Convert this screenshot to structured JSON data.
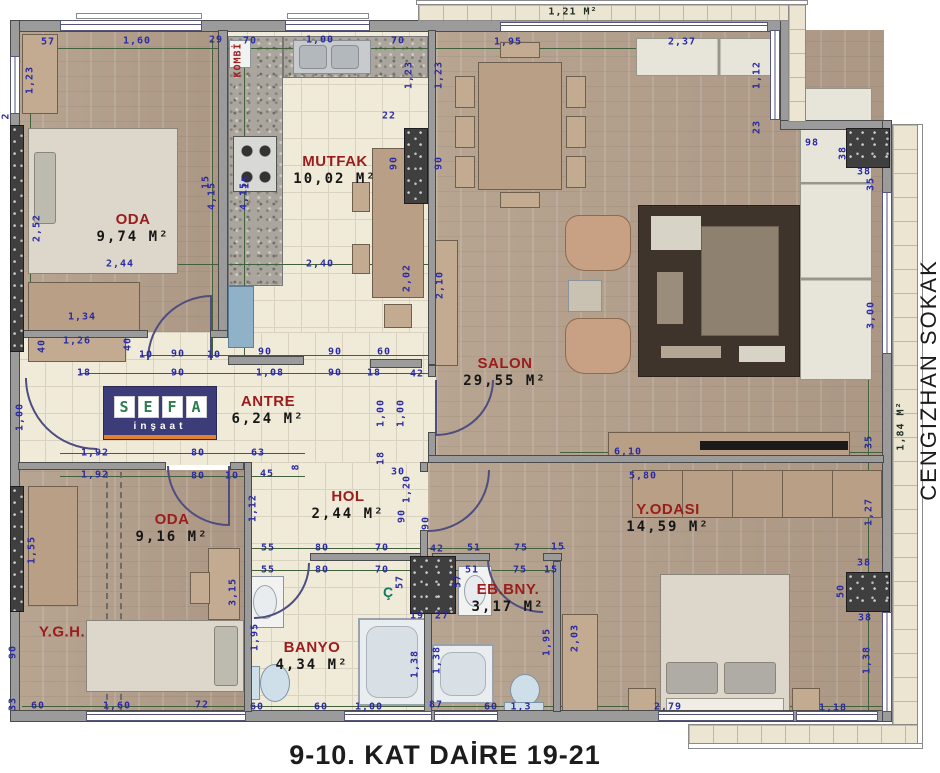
{
  "title": "9-10. KAT DAİRE 19-21",
  "street_label": "CENGIZHAN SOKAK",
  "logo": {
    "brand": "SEFA",
    "sub": "inşaat"
  },
  "shaft_label": "Ç",
  "boiler_label": "KOMBİ",
  "balcony_top_area": "1,21 M²",
  "balcony_right_area": "1,84 M²",
  "colors": {
    "dim_blue": "#2a2aa4",
    "line_green": "#42603a",
    "room_red": "#9a1c1c",
    "logo_navy": "#3c3c78",
    "logo_green": "#2e7d4f",
    "logo_orange": "#e08030"
  },
  "rooms": [
    {
      "label": "ODA",
      "area": "9,74 M²",
      "x": 133,
      "y": 228
    },
    {
      "label": "MUTFAK",
      "area": "10,02 M²",
      "x": 335,
      "y": 170
    },
    {
      "label": "SALON",
      "area": "29,55 M²",
      "x": 505,
      "y": 372
    },
    {
      "label": "ANTRE",
      "area": "6,24 M²",
      "x": 268,
      "y": 410
    },
    {
      "label": "HOL",
      "area": "2,44 M²",
      "x": 348,
      "y": 505
    },
    {
      "label": "ODA",
      "area": "9,16 M²",
      "x": 172,
      "y": 528
    },
    {
      "label": "Y.G.H.",
      "area": "",
      "x": 62,
      "y": 632
    },
    {
      "label": "BANYO",
      "area": "4,34 M²",
      "x": 312,
      "y": 656
    },
    {
      "label": "EB.BNY.",
      "area": "3,17 M²",
      "x": 508,
      "y": 598
    },
    {
      "label": "Y.ODASI",
      "area": "14,59 M²",
      "x": 668,
      "y": 518
    }
  ],
  "dimensions": [
    [
      "57",
      48,
      42,
      0
    ],
    [
      "1,60",
      137,
      41,
      0
    ],
    [
      "29",
      216,
      40,
      0
    ],
    [
      "70",
      250,
      41,
      0
    ],
    [
      "1,00",
      320,
      40,
      0
    ],
    [
      "70",
      398,
      41,
      0
    ],
    [
      "1,95",
      508,
      42,
      0
    ],
    [
      "2,37",
      682,
      42,
      0
    ],
    [
      "1,23",
      30,
      80,
      1
    ],
    [
      "2",
      6,
      116,
      1
    ],
    [
      "2,52",
      37,
      228,
      1
    ],
    [
      "1,00",
      20,
      417,
      1
    ],
    [
      "1,55",
      32,
      550,
      1
    ],
    [
      "90",
      13,
      652,
      1
    ],
    [
      "33",
      13,
      704,
      1
    ],
    [
      "2,44",
      120,
      264,
      0
    ],
    [
      "1,34",
      82,
      317,
      0
    ],
    [
      "1,26",
      77,
      341,
      0
    ],
    [
      "40",
      42,
      346,
      1
    ],
    [
      "40",
      128,
      344,
      1
    ],
    [
      "4,15",
      212,
      196,
      1
    ],
    [
      "4,15",
      244,
      196,
      1
    ],
    [
      "15",
      206,
      182,
      1
    ],
    [
      "15",
      246,
      182,
      1
    ],
    [
      "10",
      146,
      355,
      0
    ],
    [
      "90",
      178,
      354,
      0
    ],
    [
      "10",
      214,
      355,
      0
    ],
    [
      "90",
      265,
      352,
      0
    ],
    [
      "90",
      335,
      352,
      0
    ],
    [
      "60",
      384,
      352,
      0
    ],
    [
      "18",
      84,
      373,
      0
    ],
    [
      "90",
      178,
      373,
      0
    ],
    [
      "1,08",
      270,
      373,
      0
    ],
    [
      "90",
      335,
      373,
      0
    ],
    [
      "18",
      374,
      373,
      0
    ],
    [
      "42",
      417,
      374,
      0
    ],
    [
      "1,23",
      409,
      75,
      1
    ],
    [
      "1,23",
      439,
      75,
      1
    ],
    [
      "22",
      389,
      116,
      0
    ],
    [
      "90",
      394,
      163,
      1
    ],
    [
      "90",
      439,
      163,
      1
    ],
    [
      "2,40",
      320,
      264,
      0
    ],
    [
      "2,02",
      407,
      278,
      1
    ],
    [
      "2,10",
      440,
      285,
      1
    ],
    [
      "1,12",
      757,
      75,
      1
    ],
    [
      "23",
      757,
      127,
      1
    ],
    [
      "98",
      812,
      143,
      0
    ],
    [
      "38",
      843,
      153,
      1
    ],
    [
      "38",
      864,
      172,
      0
    ],
    [
      "35",
      871,
      184,
      1
    ],
    [
      "3,00",
      871,
      315,
      1
    ],
    [
      "35",
      869,
      442,
      1
    ],
    [
      "6,10",
      628,
      452,
      0
    ],
    [
      "5,80",
      643,
      476,
      0
    ],
    [
      "1,92",
      95,
      453,
      0
    ],
    [
      "80",
      198,
      453,
      0
    ],
    [
      "63",
      258,
      453,
      0
    ],
    [
      "1,92",
      95,
      475,
      0
    ],
    [
      "80",
      198,
      476,
      0
    ],
    [
      "10",
      232,
      476,
      0
    ],
    [
      "45",
      267,
      474,
      0
    ],
    [
      "8",
      296,
      467,
      1
    ],
    [
      "1,00",
      381,
      413,
      1
    ],
    [
      "1,00",
      401,
      413,
      1
    ],
    [
      "18",
      381,
      458,
      1
    ],
    [
      "30",
      398,
      472,
      0
    ],
    [
      "1,20",
      407,
      489,
      1
    ],
    [
      "90",
      402,
      516,
      1
    ],
    [
      "90",
      426,
      523,
      1
    ],
    [
      "1,12",
      253,
      508,
      1
    ],
    [
      "3,15",
      233,
      592,
      1
    ],
    [
      "1,95",
      255,
      637,
      1
    ],
    [
      "55",
      268,
      548,
      0
    ],
    [
      "80",
      322,
      548,
      0
    ],
    [
      "70",
      382,
      548,
      0
    ],
    [
      "42",
      437,
      549,
      0
    ],
    [
      "51",
      474,
      548,
      0
    ],
    [
      "75",
      521,
      548,
      0
    ],
    [
      "15",
      558,
      547,
      0
    ],
    [
      "55",
      268,
      570,
      0
    ],
    [
      "80",
      322,
      570,
      0
    ],
    [
      "70",
      382,
      570,
      0
    ],
    [
      "51",
      472,
      570,
      0
    ],
    [
      "75",
      520,
      570,
      0
    ],
    [
      "15",
      551,
      570,
      0
    ],
    [
      "57",
      400,
      582,
      1
    ],
    [
      "57",
      458,
      581,
      1
    ],
    [
      "19",
      417,
      616,
      0
    ],
    [
      "27",
      442,
      616,
      0
    ],
    [
      "1,38",
      415,
      664,
      1
    ],
    [
      "1,38",
      437,
      660,
      1
    ],
    [
      "1,95",
      547,
      642,
      1
    ],
    [
      "1,27",
      869,
      512,
      1
    ],
    [
      "38",
      864,
      563,
      0
    ],
    [
      "50",
      841,
      591,
      1
    ],
    [
      "38",
      865,
      618,
      0
    ],
    [
      "1,38",
      867,
      660,
      1
    ],
    [
      "2,03",
      575,
      638,
      1
    ],
    [
      "60",
      38,
      706,
      0
    ],
    [
      "1,60",
      117,
      706,
      0
    ],
    [
      "72",
      202,
      705,
      0
    ],
    [
      "60",
      257,
      707,
      0
    ],
    [
      "60",
      321,
      707,
      0
    ],
    [
      "1,00",
      369,
      707,
      0
    ],
    [
      "87",
      436,
      705,
      0
    ],
    [
      "60",
      491,
      707,
      0
    ],
    [
      "1,3",
      521,
      707,
      0
    ],
    [
      "2,79",
      668,
      707,
      0
    ],
    [
      "1,18",
      833,
      708,
      0
    ]
  ]
}
